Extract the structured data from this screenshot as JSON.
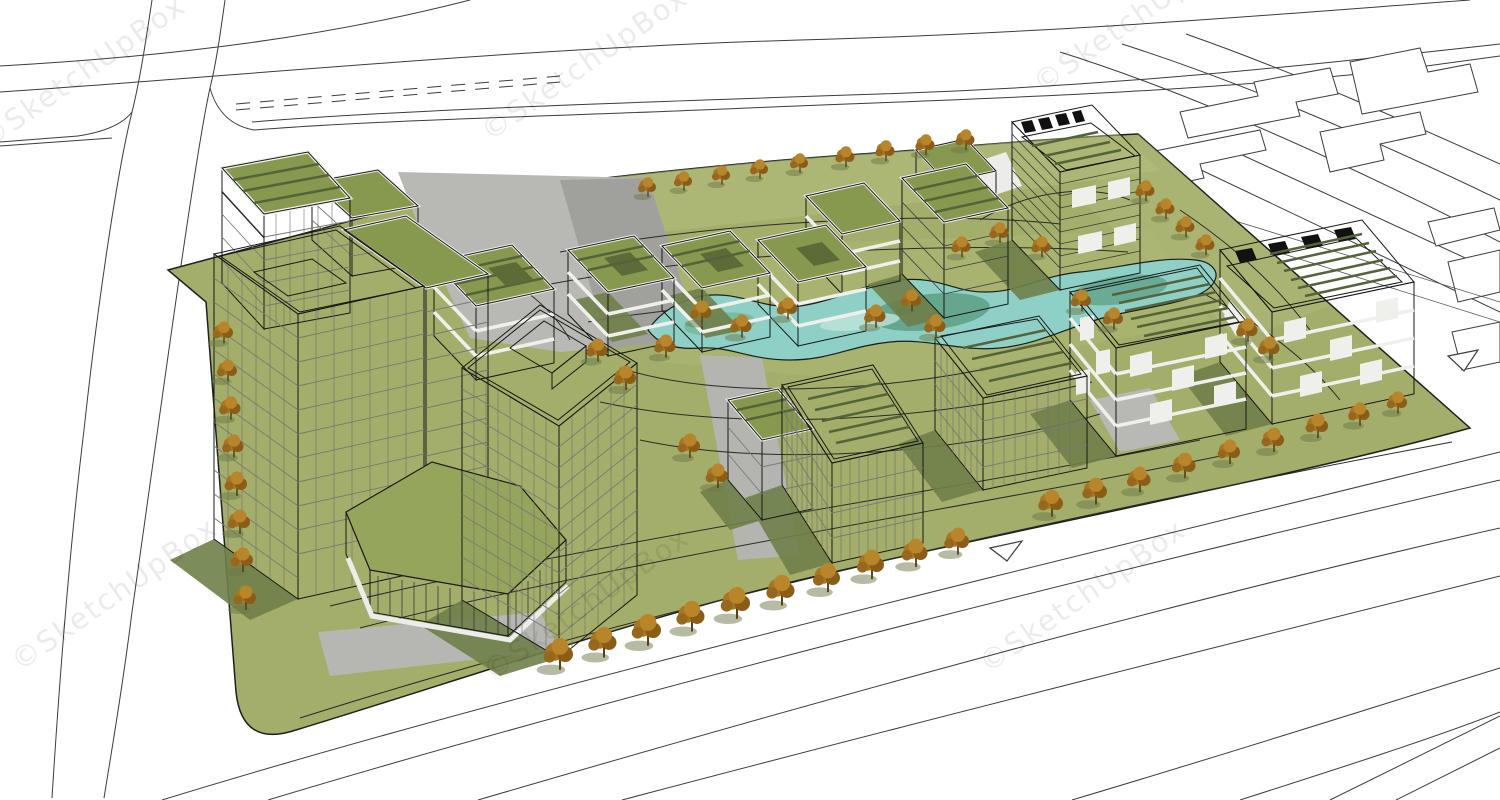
{
  "image": {
    "type": "3d-architectural-rendering",
    "style": "SketchUp massing-model render, aerial axonometric view",
    "subject": "Modern mixed-use office park city block with green-roof buildings, two white high-rise towers, a winding central pond, autumn street trees, surrounding white roads and outlined context building footprints",
    "background_color": "#ffffff"
  },
  "watermark": {
    "text": "©SketchUpBox",
    "color": "#000000",
    "opacity": 0.075,
    "rotation_deg": -35,
    "instances": 6
  },
  "palette": {
    "lawn": "#a3ae6b",
    "lawn_light": "#b4be7e",
    "lawn_shadow": "#6f8049",
    "pond_water": "#8ed0c5",
    "pond_deep": "#5a9b80",
    "roof_green": "#87994e",
    "roof_garden_dark": "#5c6b38",
    "facade_white": "#f2f2ef",
    "facade_shaded": "#d9d9d4",
    "facade_dark": "#1b1b1b",
    "plaza_gray": "#b8b8b4",
    "plaza_shadow": "#a0a09c",
    "tree_foliage": "#a9751f",
    "tree_foliage_light": "#b8852a",
    "tree_foliage_dark": "#8a5c16",
    "tree_trunk": "#5a4012",
    "road_line": "#3c3c3c",
    "water_outline": "#1c1c1c"
  },
  "scene": {
    "site": {
      "shape": "large rounded-corner parallelogram block",
      "ground": "lawn with many thin curving footpaths and gray plazas"
    },
    "pond": {
      "kind": "winding landscape pond",
      "position": "center of the site"
    },
    "trees": {
      "count": 58,
      "season": "autumn",
      "foliage": "orange"
    },
    "buildings": [
      {
        "id": "nw-terraced-block",
        "desc": "small block with stepped green terrace roof, white frame facade"
      },
      {
        "id": "nw-back-block",
        "desc": "low annex with flat green roof"
      },
      {
        "id": "west-tower",
        "desc": "13-storey white grid tower, green roof with white courtyard cut-out"
      },
      {
        "id": "west-tower-wing",
        "desc": "rear wing slab of west tower"
      },
      {
        "id": "central-tower",
        "desc": "tall white grid tower, green roof with white rooftop box"
      },
      {
        "id": "podium-hex-lawn",
        "desc": "hexagonal green podium roof over black louvered base"
      },
      {
        "id": "north-row-1",
        "desc": "mid-rise, terraced green roof with garden patches"
      },
      {
        "id": "north-row-2",
        "desc": "mid-rise, green garden roof"
      },
      {
        "id": "north-row-3",
        "desc": "mid-rise, green garden roof"
      },
      {
        "id": "north-row-4",
        "desc": "mid-rise, green garden roof"
      },
      {
        "id": "north-row-dark",
        "desc": "small dark glass block, green roof"
      },
      {
        "id": "stepped-dark-block",
        "desc": "stepped dark block with green terraced roofs"
      },
      {
        "id": "northeast-dark-tower",
        "desc": "tall dark block, checkered parapet, green roof"
      },
      {
        "id": "east-slab",
        "desc": "black-and-white checkered slab, half-striped green roof"
      },
      {
        "id": "far-east-slab",
        "desc": "large checkered slab, checkered parapet, striped green roof"
      },
      {
        "id": "south-louver-block-west",
        "desc": "white louvered office block, striped green roof"
      },
      {
        "id": "south-louver-block-east",
        "desc": "white louvered office block, striped green roof"
      },
      {
        "id": "south-terrace-wing",
        "desc": "small terraced green-roof wing"
      }
    ],
    "roads": {
      "left_road": "near-vertical avenue on the west",
      "top_boulevard": "multi-lane boulevard with dashed median along the north",
      "northeast_avenue": "avenue receding to the east",
      "south_road": "wide diagonal road along the south-east edge",
      "markings": {
        "turn_arrow_count": 2
      }
    },
    "context": "unrendered neighbouring parcels drawn as stepped outline footprints (top-right and east)"
  }
}
